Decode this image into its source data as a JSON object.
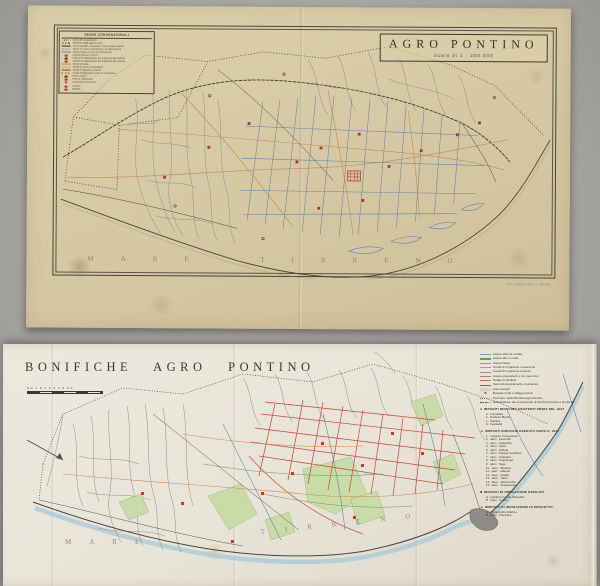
{
  "top_map": {
    "title": "AGRO PONTINO",
    "scale": "Scala di 1 : 200.000",
    "legend_title": "SEGNI CONVENZIONALI",
    "legend_items": [
      {
        "t": "dot",
        "c": "#3a372f",
        "l": "Linea del comprensorio"
      },
      {
        "t": "dash",
        "c": "#3a372f",
        "l": "Perimetro delle sezioni e lotti"
      },
      {
        "t": "line",
        "c": "#3a372f",
        "l": "Canali costruiti o sistemati e corsi d'acqua arginati"
      },
      {
        "t": "dash",
        "c": "#6b87a8",
        "l": "Canali in corso di costruzione o di sistemazione"
      },
      {
        "t": "line",
        "c": "#6b87a8",
        "l": "Corsi d'acqua in corso di sistemazione"
      },
      {
        "t": "sq",
        "c": "#b53225",
        "l": "Impianti idrovori costruiti"
      },
      {
        "t": "sq",
        "c": "#3a372f",
        "l": "Impianti di sollevamento per irrigazione gia costruiti"
      },
      {
        "t": "sq",
        "c": "#b53225",
        "l": "Impianti di sollevamento per irrigazione da costruire"
      },
      {
        "t": "line",
        "c": "#c08a50",
        "l": "Strade costruite"
      },
      {
        "t": "dash",
        "c": "#c08a50",
        "l": "Strade in corso di costruzione"
      },
      {
        "t": "line",
        "c": "#b53225",
        "l": "Canali d'irrigazione costruiti"
      },
      {
        "t": "dash",
        "c": "#b53225",
        "l": "Canali d'irrigazione in corso di costruzione"
      },
      {
        "t": "sq",
        "c": "#3a372f",
        "l": "Ponti costruiti"
      },
      {
        "t": "sq",
        "c": "#b53225",
        "l": "Ponti in costruzione"
      },
      {
        "t": "star",
        "c": "#b53225",
        "l": "Capoluogo di Provincia"
      },
      {
        "t": "sq",
        "c": "#b53225",
        "l": "Comuni"
      },
      {
        "t": "sq",
        "c": "#b53225",
        "l": "Borgate"
      }
    ],
    "sea_label": "MARE TIRRENO",
    "credit": "IST. GRAFICO — ROMA"
  },
  "bottom_map": {
    "title": "BONIFICHE  AGRO  PONTINO",
    "scale_label": "Km 1 0 1 2 3 4 5 Km",
    "sea_words": [
      "MARE",
      "TIRRENO"
    ],
    "legend": {
      "lines": [
        {
          "t": "line",
          "c": "#6f9fc0",
          "l": "Acque esterne ed alte"
        },
        {
          "t": "line",
          "c": "#6f9a55",
          "l": "Acque alte e medie"
        },
        {
          "t": "line",
          "c": "#9aa355",
          "l": "Acque basse"
        },
        {
          "t": "line",
          "c": "#cf9a55",
          "l": "Canali di irrigazione in esercizio"
        },
        {
          "t": "line",
          "c": "#9c8aa8",
          "l": "Canali di irrigazione costruiti"
        },
        {
          "t": "line",
          "c": "#8d8d86",
          "l": "Acque preesistenti e loro percorso"
        },
        {
          "t": "line",
          "c": "#c9684a",
          "l": "Strade di bonifica"
        },
        {
          "t": "line",
          "c": "#8a6a4c",
          "l": "Scoli ad essiccamento meccanico"
        },
        {
          "t": "patch",
          "c": "#b8d49a",
          "l": "Zone lacustri"
        },
        {
          "t": "star",
          "c": "#c23b2a",
          "l": "Borgate rurali e villaggi operai"
        },
        {
          "t": "dot",
          "c": "#55524a",
          "l": "Perimetro della Bonifica Agro Pontino"
        },
        {
          "t": "dashdot",
          "c": "#55524a",
          "l": "Delimitazione dei comprensori di bonifica Pontino e di Littoria"
        }
      ],
      "sections": [
        {
          "marker": "dot",
          "color": "#33302a",
          "title": "IMPIANTI IDROVORI ESISTENTI PRIMA DEL 1927",
          "items": [
            "a · Forcellata",
            "b · Pantano Binotti",
            "c · Calcara",
            "d · Cavatella"
          ]
        },
        {
          "marker": "tri",
          "color": "#c23b2a",
          "title": "IMPIANTI IDROVORI ESEGUITI DOPO IL 1927",
          "items": [
            "1 · Impianto Capograssa",
            "2 · idem · Lavorello",
            "3 · idem · Calambra",
            "4 · idem · Selce",
            "5 · idem · Chirola",
            "6 · idem · Pantani da Basso",
            "7 · idem · Calandra",
            "8 · idem · Capolonga",
            "9 · idem · Sega",
            "10 · idem · Botteria",
            "11 · idem · Materia",
            "12 · idem · Iniziati",
            "13 · idem · Tabio",
            "14 · idem · Mazzocchio",
            "15 · idem · Acquasanta"
          ]
        },
        {
          "marker": "sq",
          "color": "#33302a",
          "title": "IMPIANTI DI IRRIGAZIONE ESEGUITI",
          "items": [
            "A · Impianto Canale Mussolini",
            "B · idem · S. Vito"
          ]
        },
        {
          "marker": "tri",
          "color": "#c23b2a",
          "title": "IMPIANTI DI IRRIGAZIONE IN PROGETTO",
          "items": [
            "A · Impianto Rio Martino",
            "B · idem · Piscinara"
          ]
        }
      ]
    }
  }
}
